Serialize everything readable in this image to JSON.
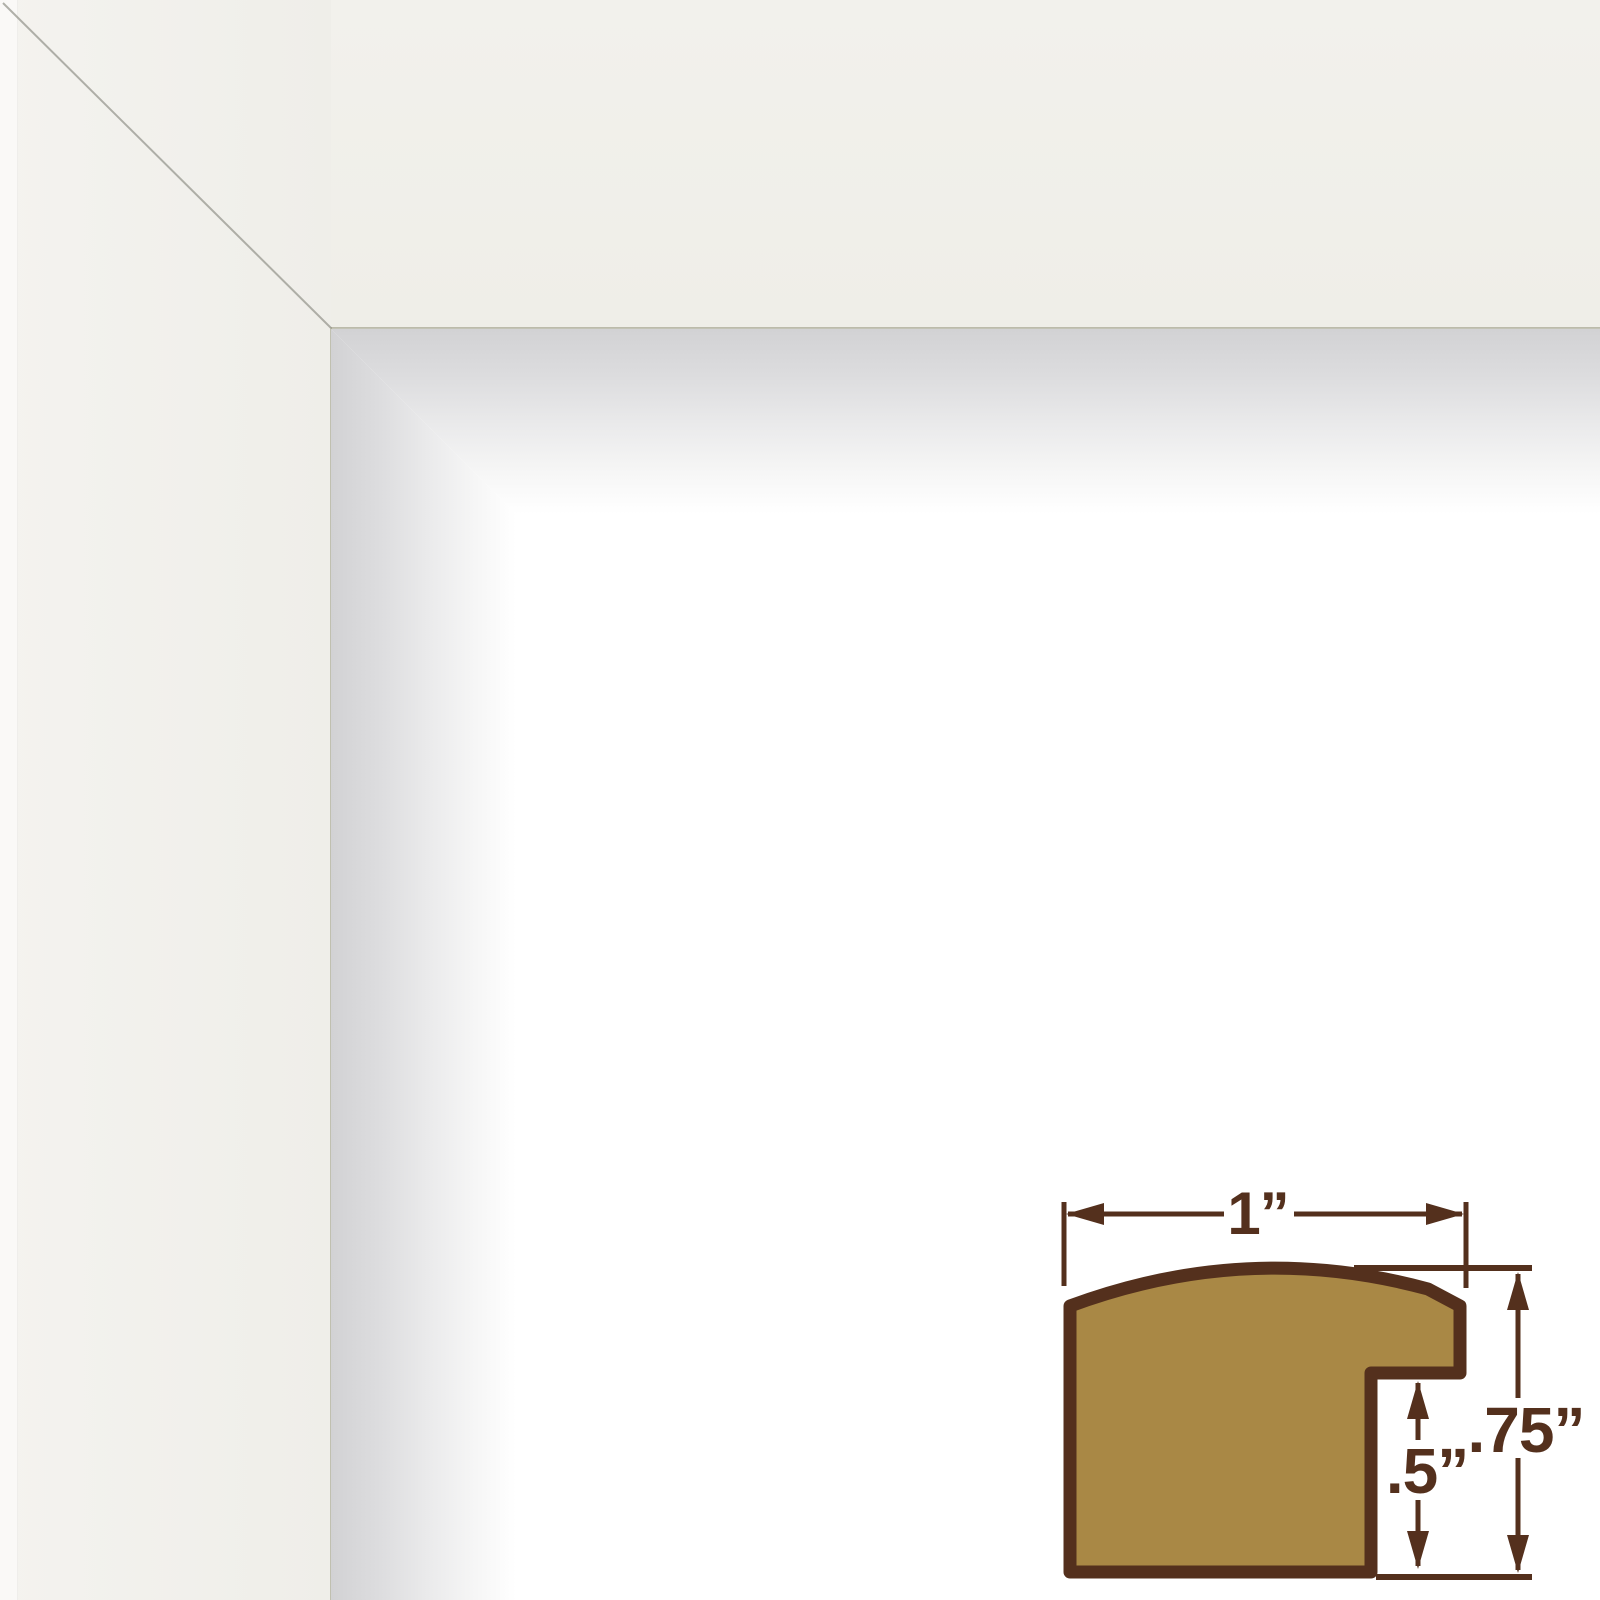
{
  "photo": {
    "subject": "white picture frame corner sample",
    "colors": {
      "frame_face": "#f0efe9",
      "inner_shadow_start": "#d2d2d4",
      "background": "#ffffff",
      "miter_line": "#9e9e96"
    }
  },
  "diagram": {
    "subject": "molding cross-section profile with dimensions",
    "width_label": "1”",
    "rabbet_depth_label": ".5”",
    "height_label": ".75”",
    "colors": {
      "outline": "#54301d",
      "wood_fill": "#a98845"
    }
  }
}
